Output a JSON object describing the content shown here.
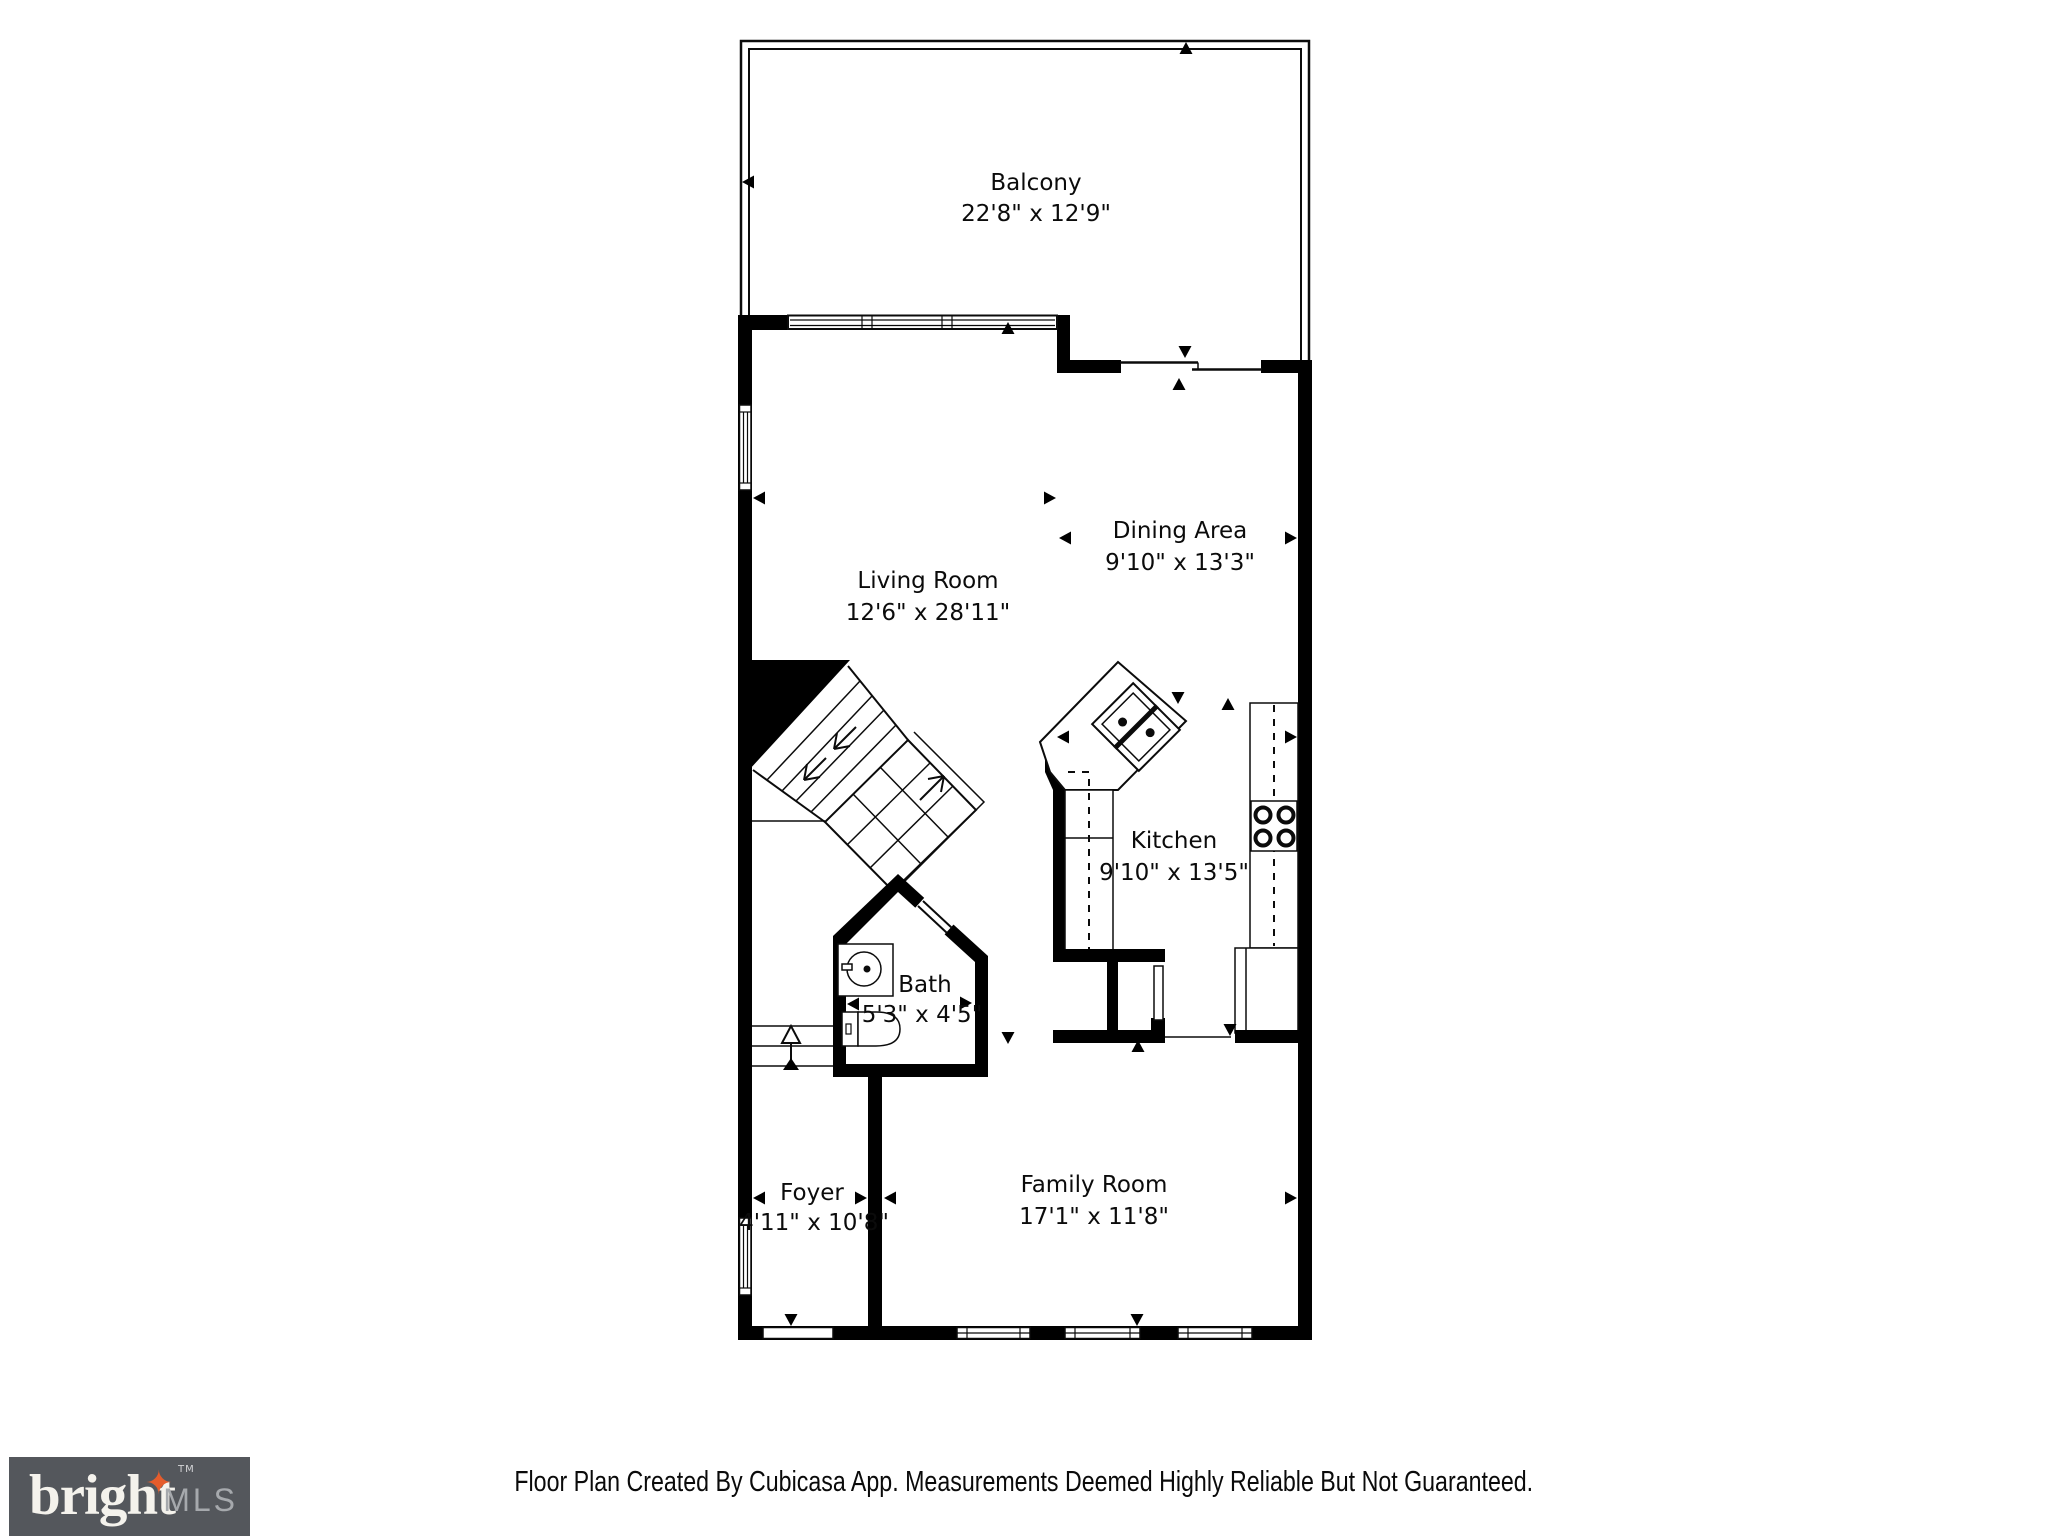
{
  "plan": {
    "rooms": {
      "balcony": {
        "name": "Balcony",
        "dims": "22'8\" x 12'9\""
      },
      "living_room": {
        "name": "Living Room",
        "dims": "12'6\" x 28'11\""
      },
      "dining_area": {
        "name": "Dining Area",
        "dims": "9'10\" x 13'3\""
      },
      "kitchen": {
        "name": "Kitchen",
        "dims": "9'10\" x 13'5\""
      },
      "bath": {
        "name": "Bath",
        "dims": "5'3\" x 4'5\""
      },
      "foyer": {
        "name": "Foyer",
        "dims": "4'11\" x 10'8\""
      },
      "family_room": {
        "name": "Family Room",
        "dims": "17'1\" x 11'8\""
      }
    }
  },
  "footer": {
    "disclaimer": "Floor Plan Created By Cubicasa App. Measurements Deemed Highly Reliable But Not Guaranteed.",
    "logo": {
      "brand": "bright",
      "star": "✦",
      "tm": "TM",
      "suffix": "MLS"
    }
  },
  "colors": {
    "wall": "#000000",
    "background": "#ffffff",
    "logo_background": "#54575c",
    "logo_brand_text": "#f4f2ec",
    "logo_star": "#e55c2c",
    "logo_mls_text": "#a6a9ad"
  }
}
